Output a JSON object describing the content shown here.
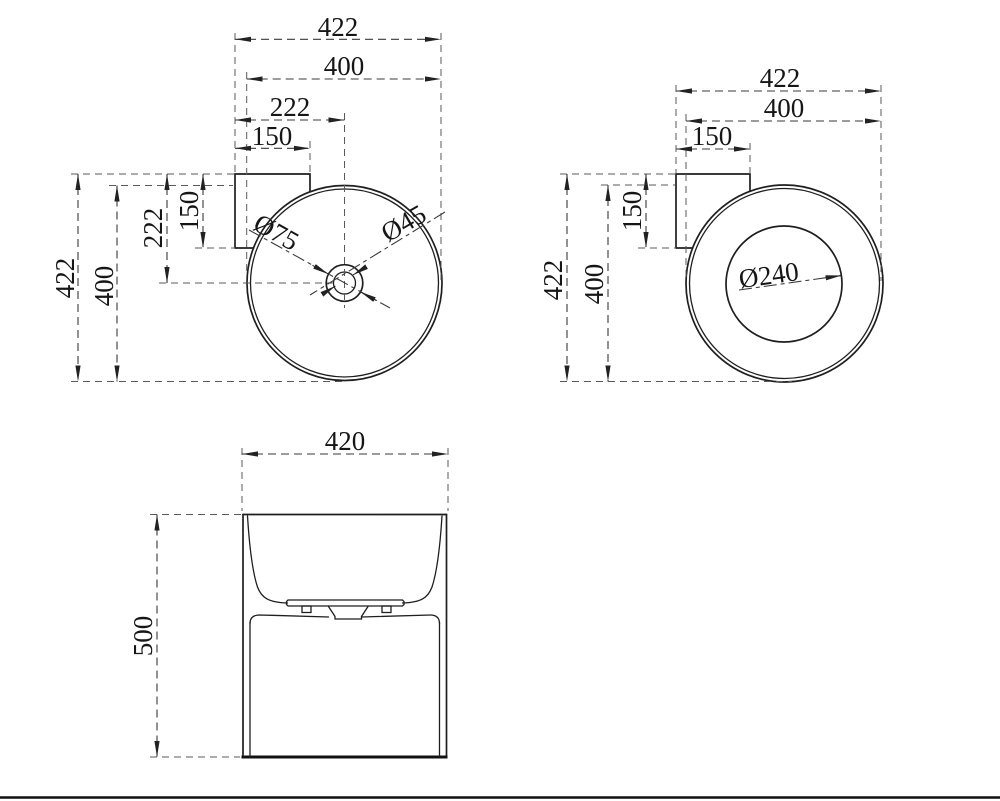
{
  "drawing": {
    "background": "#ffffff",
    "line_color": "#1f1f1f",
    "views": {
      "plan_left": {
        "dims": {
          "width_overall": "422",
          "width_basin": "400",
          "center_x": "222",
          "deck_width": "150",
          "depth_overall": "422",
          "depth_basin": "400",
          "center_y": "222",
          "deck_depth": "150"
        },
        "labels": {
          "drain_outer": "Ø75",
          "drain_inner": "Ø45"
        }
      },
      "plan_right": {
        "dims": {
          "width_overall": "422",
          "width_basin": "400",
          "deck_width": "150",
          "depth_overall": "422",
          "depth_basin": "400",
          "deck_depth": "150"
        },
        "labels": {
          "bowl_bottom": "Ø240"
        }
      },
      "front": {
        "dims": {
          "width": "420",
          "height": "500"
        }
      }
    }
  }
}
